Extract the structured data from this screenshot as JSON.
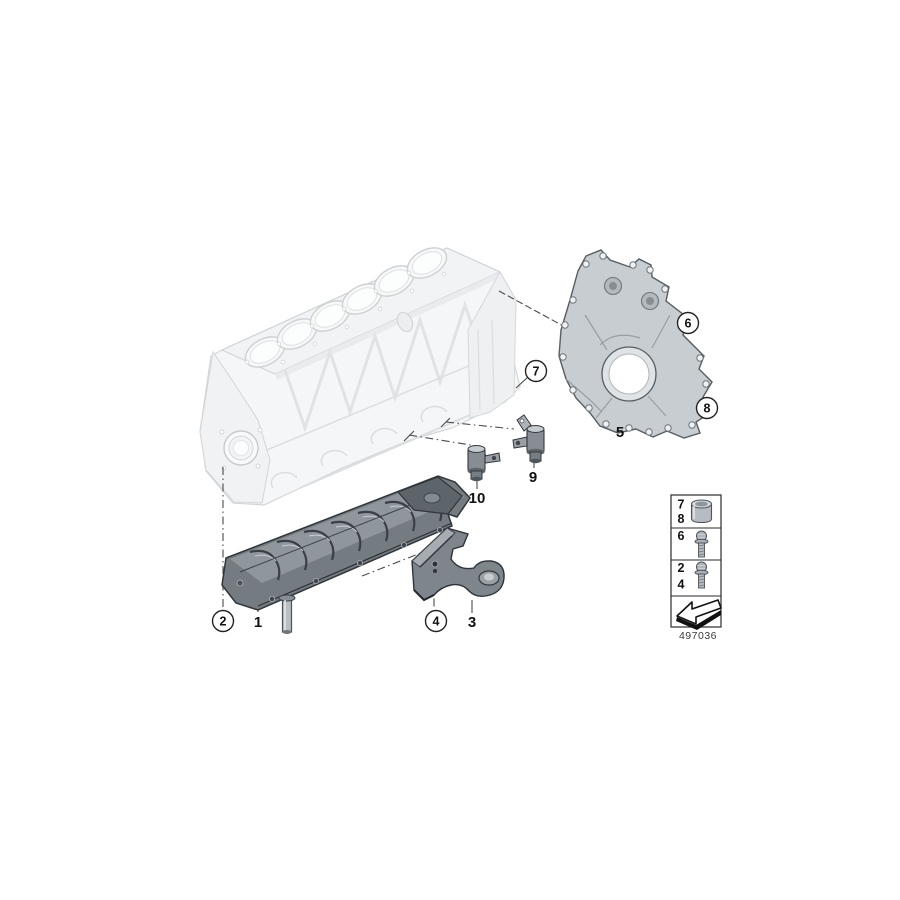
{
  "diagram": {
    "number": "497036"
  },
  "callouts": {
    "c1": "1",
    "c2": "2",
    "c3": "3",
    "c4": "4",
    "c5": "5",
    "c6": "6",
    "c7": "7",
    "c8": "8",
    "c9": "9",
    "c10": "10"
  },
  "legend": {
    "row1": {
      "top": "7",
      "bottom": "8",
      "icon": "dowel-sleeve-icon"
    },
    "row2": {
      "label": "6",
      "icon": "flange-bolt-icon"
    },
    "row3": {
      "top": "2",
      "bottom": "4",
      "icon": "flange-bolt-icon"
    },
    "row4": {
      "icon": "direction-arrow-icon"
    }
  },
  "colors": {
    "background": "#ffffff",
    "line": "#1a1a1a",
    "block_faded": "#eef0f2",
    "cover_gray": "#c8cdd1",
    "baffle_dark": "#747b81"
  }
}
